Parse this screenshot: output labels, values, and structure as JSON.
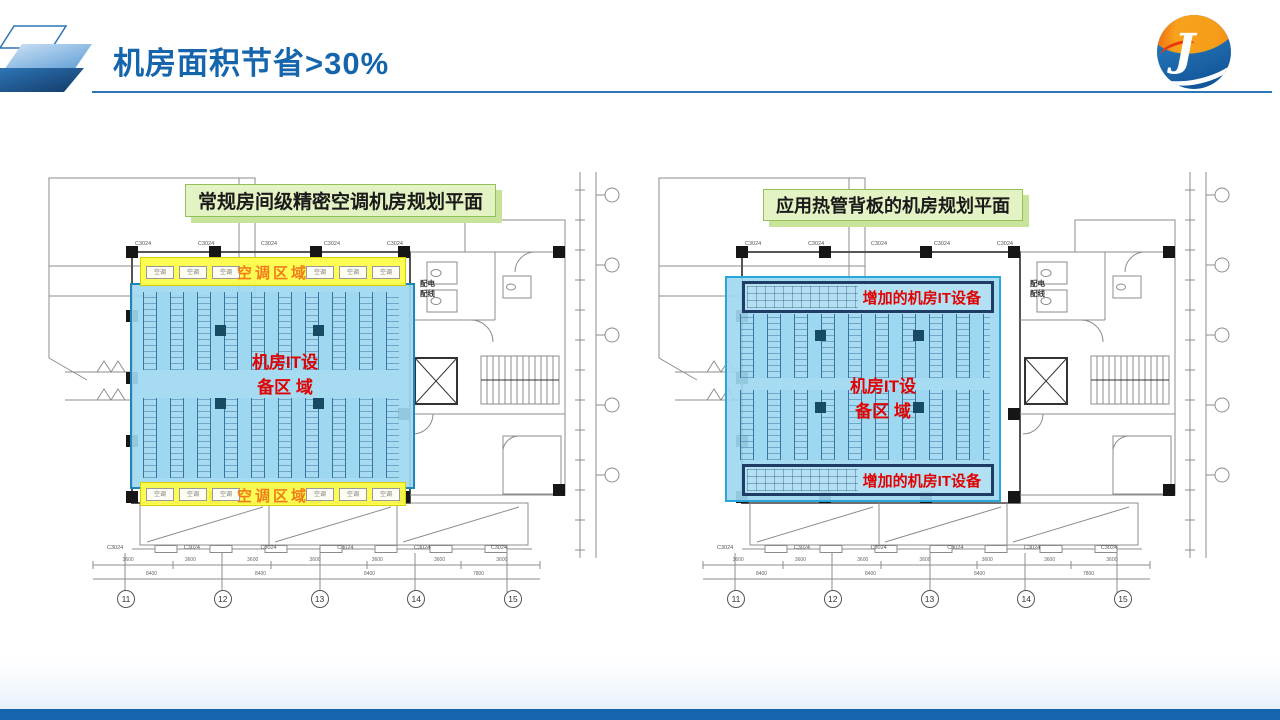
{
  "slide": {
    "title": "机房面积节省>30%"
  },
  "icons": {
    "logo": "jp-globe-swoosh-logo",
    "logo_glyph": "J"
  },
  "plans": {
    "left": {
      "caption": "常规房间级精密空调机房规划平面",
      "ac_zone_label_top": "空调区域",
      "ac_zone_label_bottom": "空调区域",
      "it_zone_line1": "机房IT设",
      "it_zone_line2": "备区 域"
    },
    "right": {
      "caption": "应用热管背板的机房规划平面",
      "added_it_label_top": "增加的机房IT设备",
      "added_it_label_bottom": "增加的机房IT设备",
      "it_zone_line1": "机房IT设",
      "it_zone_line2": "备区 域"
    },
    "axis_columns": [
      "11",
      "12",
      "13",
      "14",
      "15"
    ],
    "dims_top": [
      "3600",
      "3600",
      "3600",
      "3600",
      "3600",
      "3600",
      "3600"
    ],
    "dims_bottom": [
      "8400",
      "8400",
      "8400",
      "7800"
    ],
    "window_labels_top": [
      "C3024",
      "C3024",
      "C3024",
      "C3024",
      "C3024"
    ],
    "window_labels_bottom": [
      "C3024",
      "C3024",
      "C3024",
      "C3024",
      "C3024",
      "C3024"
    ],
    "ac_units": [
      "空调",
      "空调",
      "空调"
    ],
    "rooms": {
      "power_line1": "配电",
      "power_line2": "配线"
    }
  },
  "colors": {
    "title_blue": "#1565ad",
    "footer_blue": "#1565ad",
    "zone_blue_fill": "#9ed8f0",
    "zone_blue_border": "#1f86bb",
    "ac_band_yellow": "#fdfd4a",
    "ac_label_orange": "#f07d1c",
    "it_label_red": "#e00202",
    "added_box_navy": "#1e3c64",
    "caption_green_fill": "#e4f3c3",
    "caption_green_border": "#94bf5a"
  }
}
